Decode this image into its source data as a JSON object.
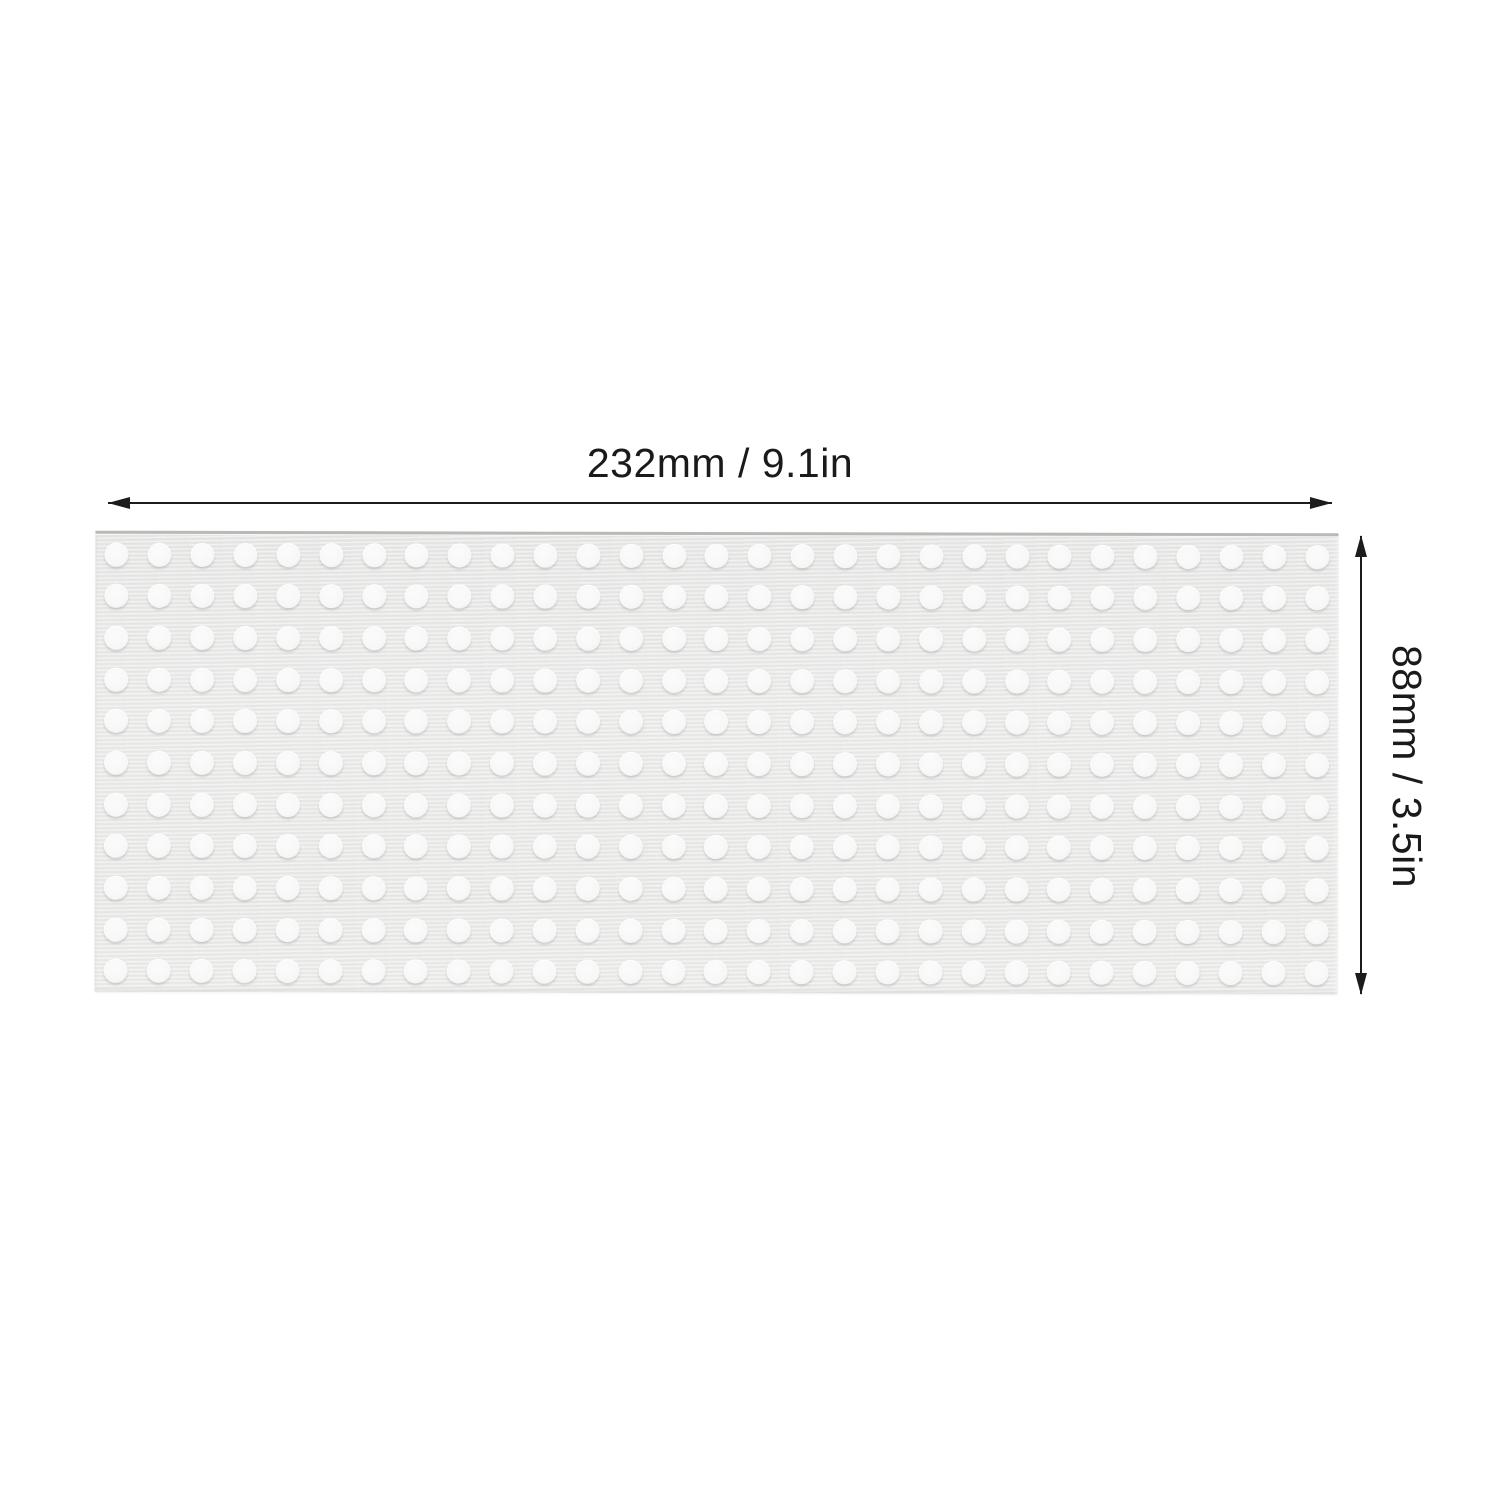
{
  "image": {
    "kind": "product-dimension-diagram",
    "background_color": "#ffffff"
  },
  "dimensions": {
    "width_label": "232mm / 9.1in",
    "height_label": "88mm / 3.5in",
    "line_color": "#1c1c1c",
    "label_color": "#1a1a1a"
  },
  "panel": {
    "description": "light gray perforated baseplate with raised white studs",
    "stud_rows": 11,
    "stud_cols": 29,
    "base_color": "#e9e9e8",
    "edge_color": "#b9b9b7",
    "stud_color": "#f8f8f8"
  }
}
